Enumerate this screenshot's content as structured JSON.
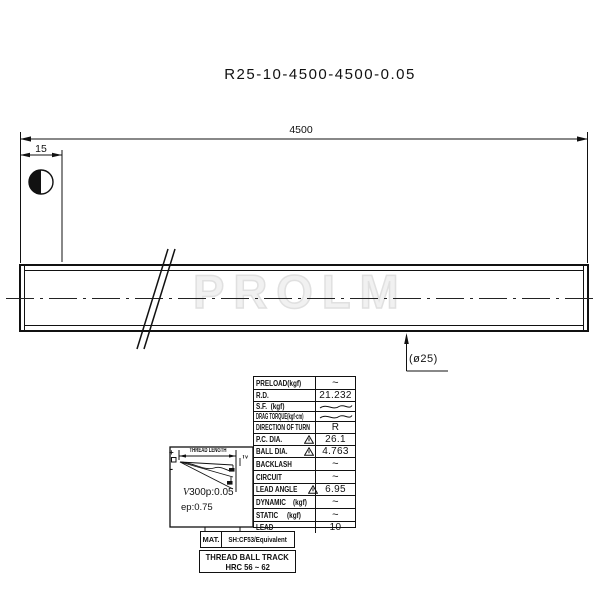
{
  "title": "R25-10-4500-4500-0.05",
  "watermark": "PROLM",
  "drawing": {
    "overall_length_dim": "4500",
    "end_dim": "15",
    "diameter_label": "(ø25)"
  },
  "lead_error_inset": {
    "heading": "THREAD LENGTH",
    "plus_mark": "+",
    "minus_mark": "-",
    "bracket_label": "Tv",
    "v300_prefix": "V",
    "v300_value": "300p:0.05",
    "ep_label": "ep:0.75"
  },
  "spec_table": {
    "rows": [
      {
        "label": "PRELOAD(kgf)",
        "value": "~"
      },
      {
        "label": "R.D.",
        "value": "21.232"
      },
      {
        "label": "S.F.  (kgf)",
        "value": ""
      },
      {
        "label": "DRAG TORQUE(kgf·cm)",
        "value": ""
      },
      {
        "label": "DIRECTION OF TURN",
        "value": "R"
      },
      {
        "label": "P.C. DIA.",
        "value": "26.1"
      },
      {
        "label": "BALL DIA.",
        "value": "4.763"
      },
      {
        "label": "BACKLASH",
        "value": "~"
      },
      {
        "label": "CIRCUIT",
        "value": "~"
      },
      {
        "label": "LEAD ANGLE",
        "value": "6.95"
      },
      {
        "label": "DYNAMIC    (kgf)",
        "value": "~"
      },
      {
        "label": "STATIC     (kgf)",
        "value": "~"
      },
      {
        "label": "LEAD",
        "value": "10"
      }
    ]
  },
  "material_table": {
    "label": "MAT.",
    "value": "SH:CF53/Equivalent"
  },
  "hardness_table": {
    "line1": "THREAD BALL TRACK",
    "line2": "HRC 56 ~ 62"
  },
  "colors": {
    "line": "#111111",
    "watermark": "#e0e0e0"
  }
}
